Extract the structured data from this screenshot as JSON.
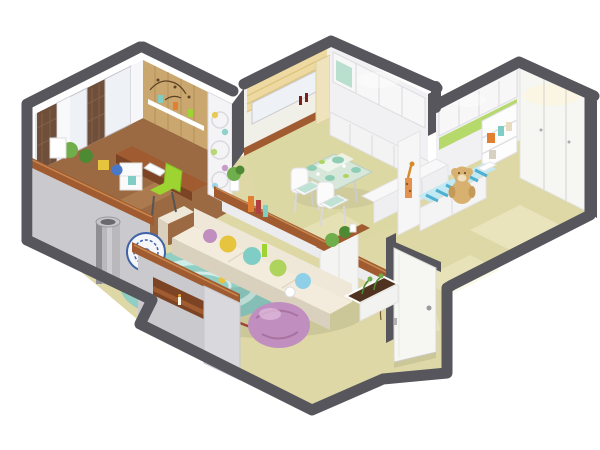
{
  "scene": {
    "kind": "isometric-apartment-cutaway-render",
    "background": "#ffffff"
  },
  "colors": {
    "background": "#ffffff",
    "wall_dark": "#56565c",
    "wall_mid": "#8a8a90",
    "wall_light_face": "#c9c9ce",
    "wall_lighter": "#e4e4e7",
    "wall_white": "#f1f1f3",
    "window_glass": "#eef2f6",
    "sheer_curtain": "#f7f7f9",
    "plaid_curtain": "#6f4f3a",
    "wood_plank_wall": "#c9a76e",
    "wood_top": "#a05c30",
    "wood_dark": "#7c4424",
    "wood_floor": "#9c6a42",
    "floor_beige": "#ded8a6",
    "floor_green_tint": "#dcd9a4",
    "floor_highlight": "#f4efcf",
    "roman_blind": "#eed9a0",
    "divider_white": "#f4f4f6",
    "sofa_cream": "#efe8d8",
    "sofa_shadow": "#d9d1bd",
    "rug_teal": "#8ccfc5",
    "rug_pattern": "#cdeee8",
    "beanbag_pink": "#c08fc0",
    "beanbag_highlight": "#ddb8da",
    "chair_green": "#9ed431",
    "accent_green_band": "#b5d96a",
    "dish_teal": "#8fceb4",
    "cushion_yellow": "#e6c43e",
    "cushion_teal": "#7fcdc4",
    "cushion_green": "#aed45e",
    "cushion_blue": "#8fd0e8",
    "mattress_blue": "#4fb0d2",
    "mattress_light": "#c3e9f2",
    "teddy_tan": "#d8b170",
    "soil_brown": "#4f3320",
    "plant_green": "#6fae4a",
    "plant_dark": "#4e8a34",
    "steel_gray": "#b9b9bd",
    "plate_blue": "#3f62a8",
    "book_orange": "#e08030",
    "door_white": "#f6f6f3",
    "glass_table": "#d7e9de",
    "glow_warm": "#fff6d8"
  },
  "rooms": {
    "study_bedroom": [
      "curtained-windows",
      "wood-accent-wall",
      "floating-shelf",
      "desk",
      "desk-chair",
      "room-divider-screen",
      "bay-storage-wall"
    ],
    "living_room": [
      "sofa",
      "throw-pillows",
      "area-rug",
      "bean-bag",
      "planter-box",
      "tv-half-wall",
      "metal-planter",
      "decorative-plate"
    ],
    "kitchen_dining": [
      "roman-blind-window",
      "upper-cabinets",
      "counter-half-wall",
      "dining-table",
      "dining-chairs",
      "storage-bench"
    ],
    "kids_room": [
      "wardrobe-wall",
      "green-accent-shelf",
      "bookshelf",
      "teddy-bear",
      "kids-bed"
    ],
    "entry": [
      "entry-wardrobe",
      "entry-door",
      "shoe-cabinet"
    ]
  }
}
